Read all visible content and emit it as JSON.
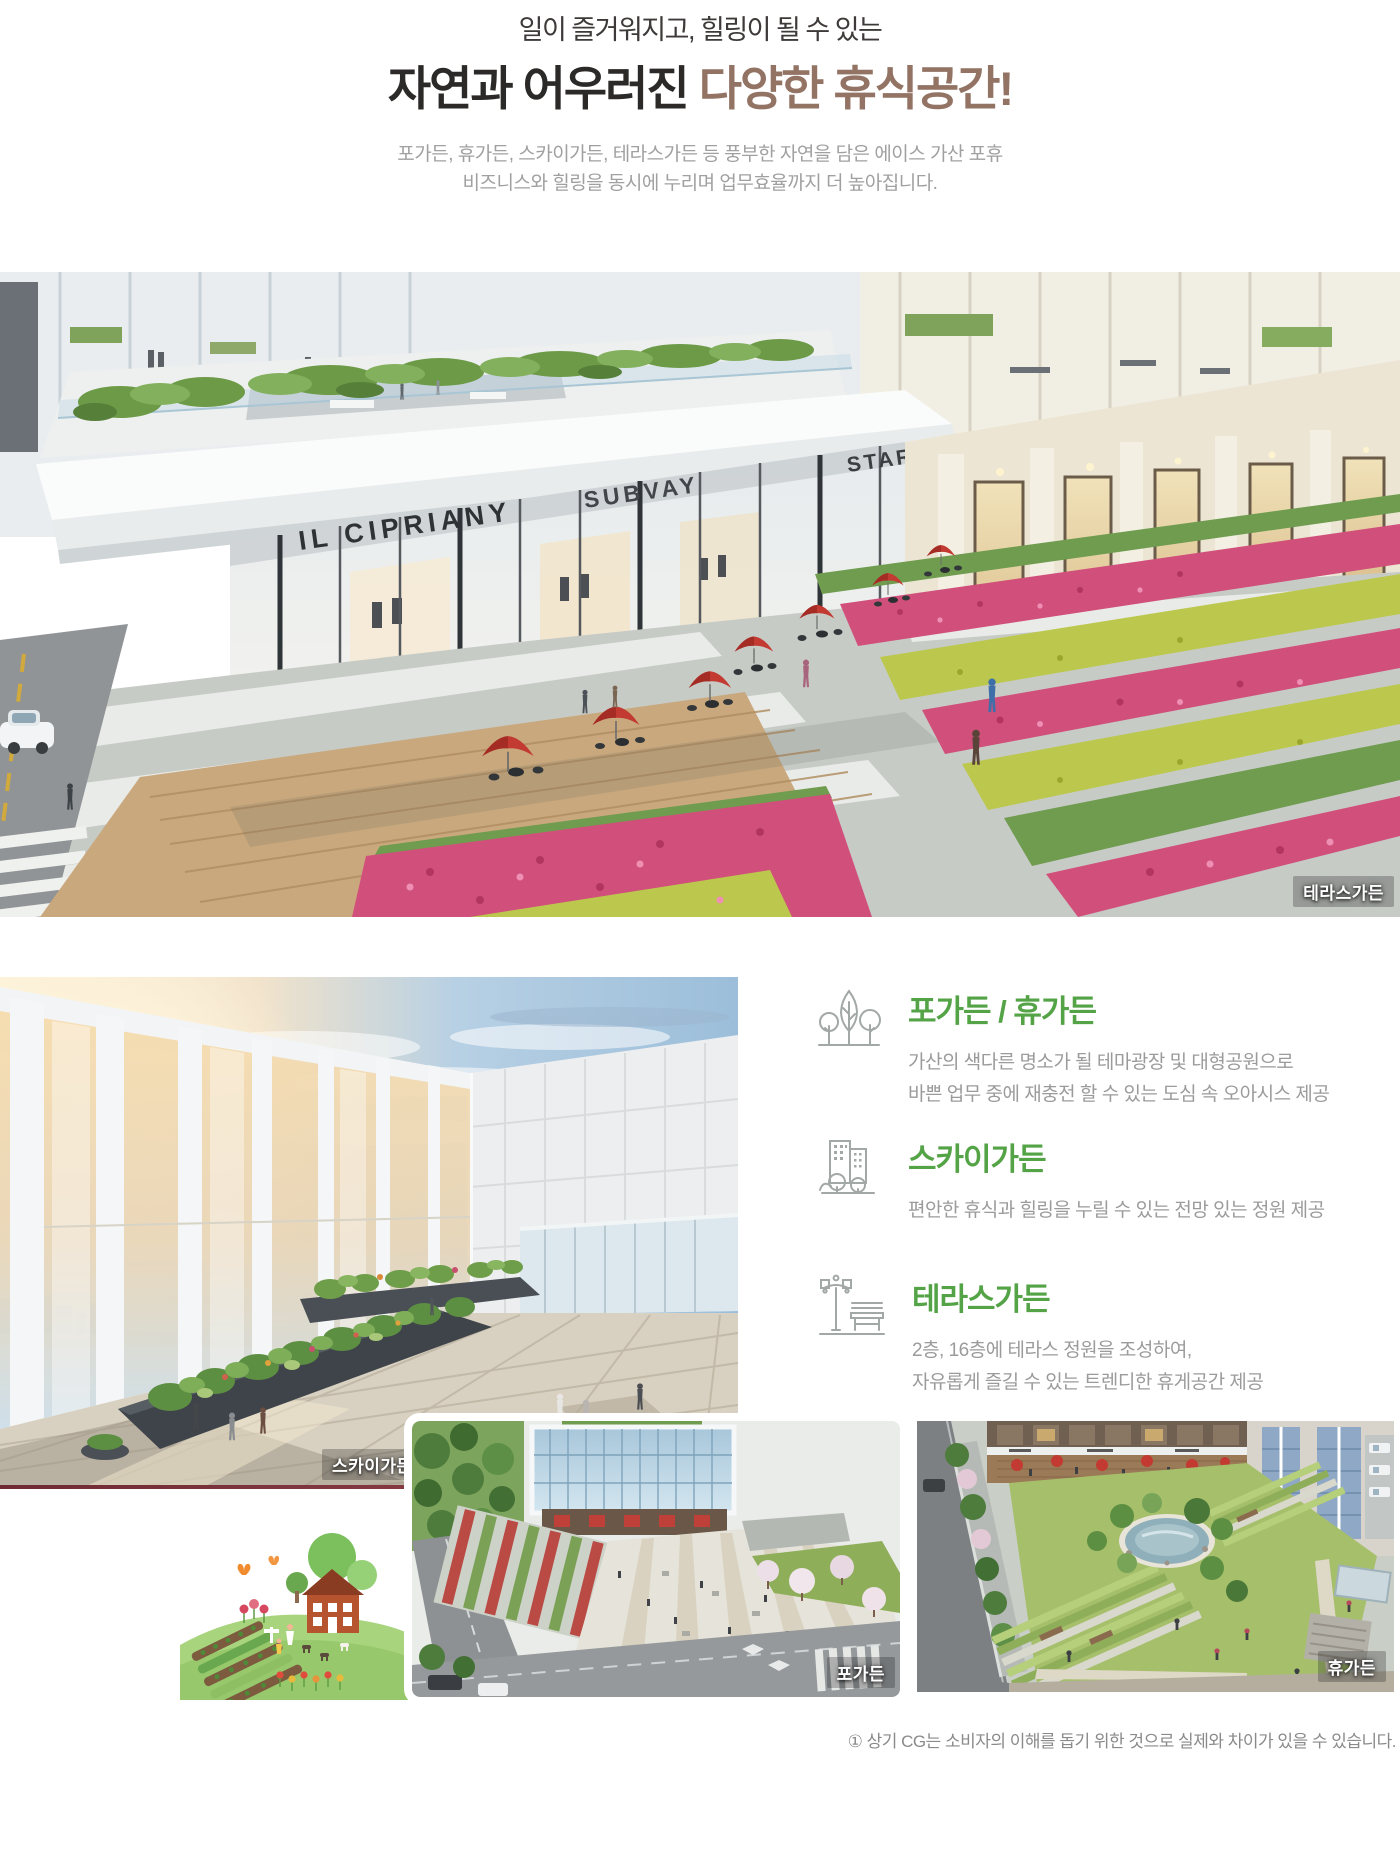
{
  "header": {
    "subtitle": "일이 즐거워지고, 힐링이 될 수 있는",
    "title_normal": "자연과 어우러진 ",
    "title_accent": "다양한 휴식공간!",
    "desc_line1": "포가든, 휴가든, 스카이가든, 테라스가든 등 풍부한 자연을 담은 에이스 가산 포휴",
    "desc_line2": "비즈니스와 힐링을 동시에 누리며 업무효율까지 더 높아집니다."
  },
  "hero": {
    "label": "테라스가든",
    "signs": {
      "left": "IL CIPRIANY",
      "center": "SUBVAY",
      "right": "STAR BACKS"
    }
  },
  "gallery": {
    "sky_garden_label": "스카이가든",
    "po_garden_label": "포가든",
    "hyu_garden_label": "휴가든"
  },
  "features": [
    {
      "icon": "trees-icon",
      "title": "포가든 / 휴가든",
      "lines": [
        "가산의 색다른 명소가 될 테마광장 및 대형공원으로",
        "바쁜 업무 중에 재충전 할 수 있는 도심 속 오아시스 제공"
      ]
    },
    {
      "icon": "city-garden-icon",
      "title": "스카이가든",
      "lines": [
        "편안한 휴식과 힐링을 누릴 수 있는 전망 있는 정원 제공"
      ]
    },
    {
      "icon": "lamp-bench-icon",
      "title": "테라스가든",
      "lines": [
        "2층, 16층에 테라스 정원을 조성하여,",
        "자유롭게 즐길 수 있는 트렌디한 휴게공간 제공"
      ]
    }
  ],
  "footnote": "① 상기 CG는 소비자의 이해를 돕기 위한 것으로 실제와 차이가 있을 수 있습니다.",
  "colors": {
    "title_accent": "#927364",
    "heading_green": "#54a447",
    "body_gray": "#9b9b9b",
    "umbrella_red": "#c23a31",
    "flower_pink": "#d0507b",
    "shrub_yellow": "#bcc84d"
  }
}
